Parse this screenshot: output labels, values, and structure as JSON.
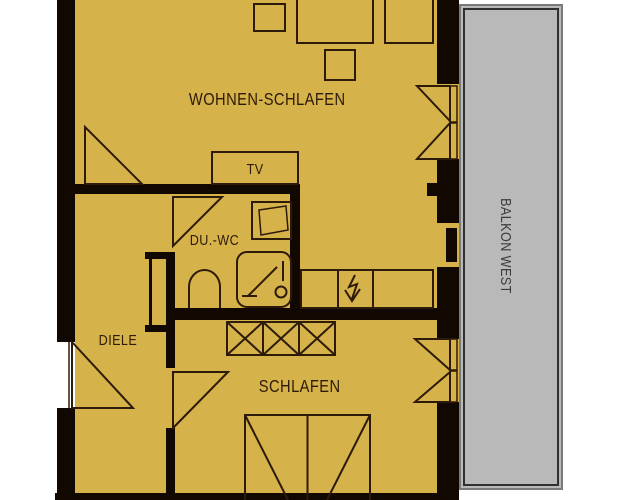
{
  "plan": {
    "type": "apartment-floor-plan",
    "rooms": {
      "wohnen_schlafen": "WOHNEN-SCHLAFEN",
      "tv": "TV",
      "du_wc": "DU.-WC",
      "diele": "DIELE",
      "schlafen": "SCHLAFEN",
      "balkon_west": "BALKON WEST"
    },
    "colors": {
      "background": "#ffffff",
      "floor": "#d5b24a",
      "wall": "#120802",
      "line": "#2e1a08",
      "balcony_fill": "#b9b9b9",
      "balcony_border_outer": "#7a7a7a",
      "balcony_border_inner": "#303030",
      "balcony_text": "#3c3c3c"
    }
  }
}
